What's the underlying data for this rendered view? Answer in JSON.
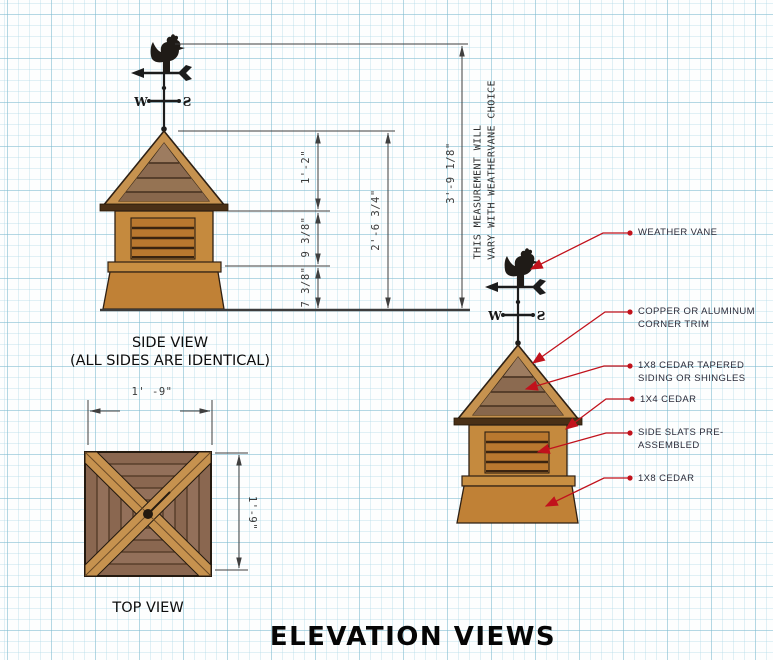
{
  "drawing": {
    "title": "ELEVATION VIEWS",
    "side_view": {
      "caption": "SIDE VIEW",
      "caption_note": "(ALL SIDES ARE IDENTICAL)",
      "dim_roof_height": "1'-2\"",
      "dim_louver_height": "9 3/8\"",
      "dim_base_height": "7 3/8\"",
      "dim_cupola_height": "2'-6 3/4\"",
      "dim_total_height": "3'-9 1/8\"",
      "note_line1": "THIS MEASUREMENT WILL",
      "note_line2": "VARY WITH WEATHERVANE CHOICE"
    },
    "top_view": {
      "caption": "TOP VIEW",
      "dim_width": "1' -9\"",
      "dim_depth": "1'-9\""
    },
    "weathervane": {
      "letter_west": "W",
      "letter_south": "S"
    },
    "callouts": [
      {
        "line1": "WEATHER VANE",
        "line2": ""
      },
      {
        "line1": "COPPER OR ALUMINUM",
        "line2": "CORNER TRIM"
      },
      {
        "line1": "1X8 CEDAR TAPERED",
        "line2": "SIDING OR SHINGLES"
      },
      {
        "line1": "1X4 CEDAR",
        "line2": ""
      },
      {
        "line1": "SIDE SLATS PRE-",
        "line2": "ASSEMBLED"
      },
      {
        "line1": "1X8 CEDAR",
        "line2": ""
      }
    ],
    "colors": {
      "leader_red": "#c1121c",
      "wood_trim": "#c6924f",
      "wood_body": "#c58a3e",
      "wood_louver": "#b9782f",
      "wood_shingle": "#927155",
      "dim_line": "#3f3f3f",
      "grid_line": "#bfe0ea"
    }
  }
}
